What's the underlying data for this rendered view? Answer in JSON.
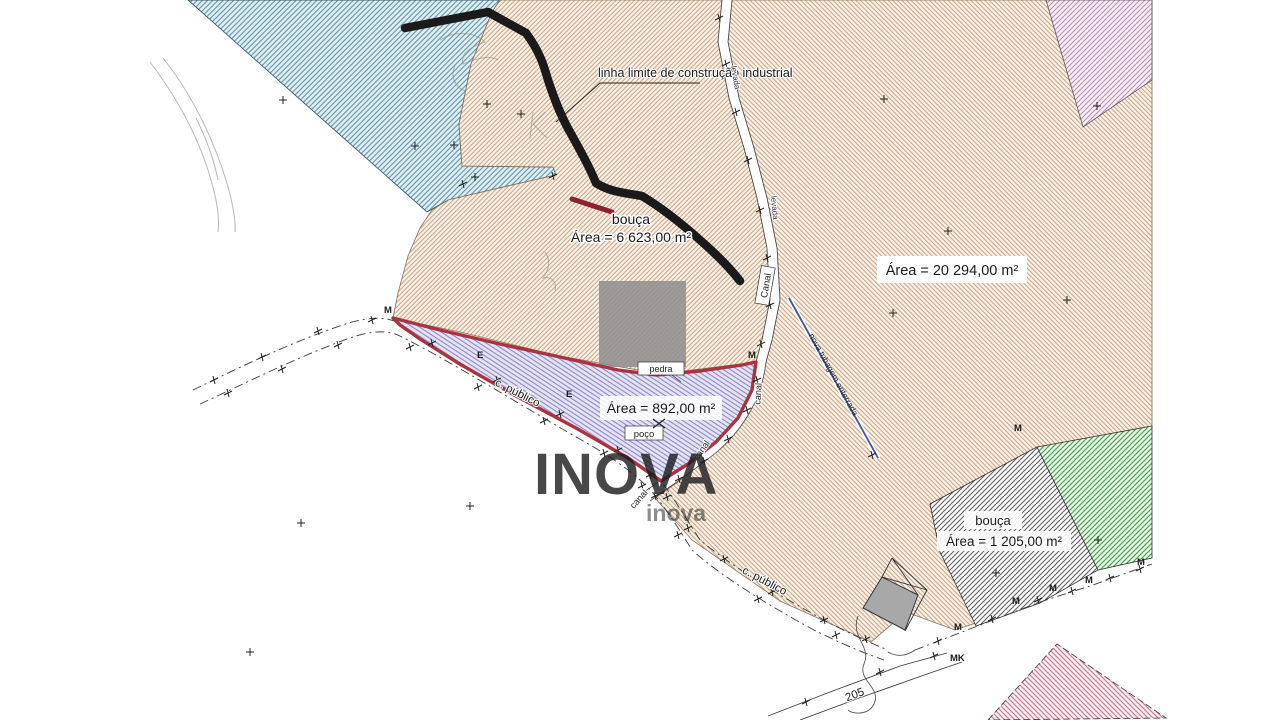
{
  "labels": {
    "limit_line": "linha limite de construção industrial",
    "bouca": "bouça",
    "area_bouca_top": "Área = 6 623,00 m²",
    "area_large": "Área = 20 294,00 m²",
    "area_subject": "Área = 892,00 m²",
    "area_bouca_right": "Área = 1 205,00 m²",
    "pedra": "pedra",
    "poco": "poço",
    "canal": "canal",
    "canal_box": "Canal",
    "levada": "levada",
    "c_publico": "c. público",
    "nova_tubagem": "nova tubagem enterrada",
    "road_205": "205",
    "marker_m": "M",
    "marker_e": "E",
    "marker_mk": "MK"
  },
  "watermark": {
    "text": "INOVA",
    "subtext": "inova"
  },
  "colors": {
    "tan_hatch": "#c9a183",
    "blue_hatch": "#5b98ab",
    "subject_hatch": "#8284c4",
    "subject_outline": "#a9343f",
    "green_hatch": "#4aa54f",
    "gray_hatch": "#616161",
    "pink_top_hatch": "#bd8fb5",
    "pink_bottom_hatch": "#cb7d98",
    "limit_line": "#1a1a1a",
    "tubagem_line": "#3f55a0"
  }
}
